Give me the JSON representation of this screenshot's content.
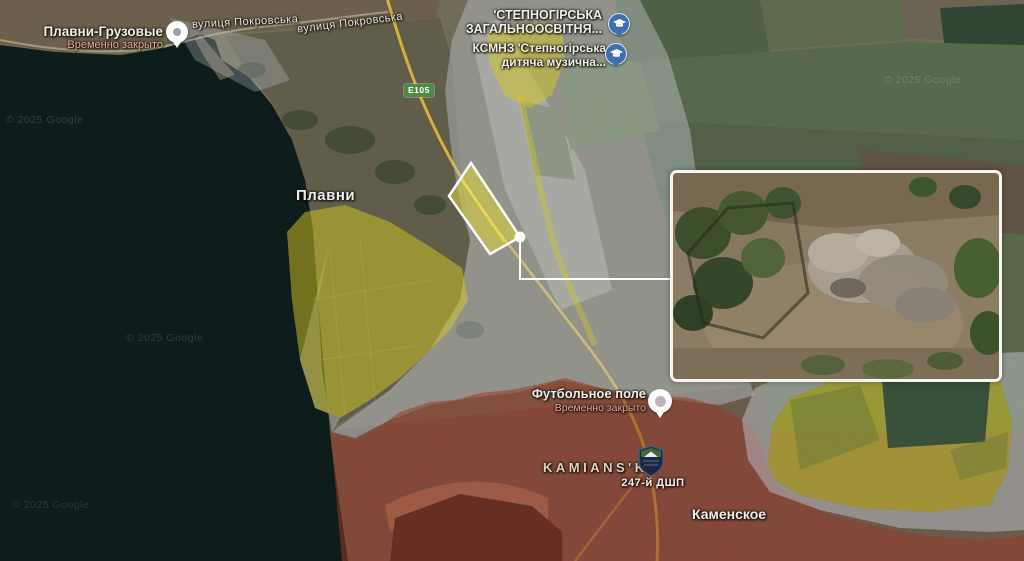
{
  "colors": {
    "zone_yellow": "#d6c821",
    "zone_red": "#96382a",
    "zone_gray": "#bcc3cc",
    "route_badge_bg": "#4e8c44",
    "school_pin_bg": "#3f6fae",
    "closed_status_color": "#e7a89e"
  },
  "labels": {
    "port_title": "Плавни-Грузовые",
    "port_status": "Временно закрыто",
    "street": "вулиця Покровська",
    "school1_line1": "'СТЕПНОГІРСЬКА",
    "school1_line2": "ЗАГАЛЬНООСВІТНЯ...",
    "school2_line1": "КСМНЗ 'Степногірська",
    "school2_line2": "дитяча музична...",
    "town_plavni": "Плавни",
    "route_badge": "E105",
    "football_title": "Футбольное поле",
    "football_status": "Временно закрыто",
    "city_kamianske": "KAMIANS'KE",
    "unit_badge": "247-й ДШП",
    "town_kamenskoe": "Каменское",
    "copyright": "© 2025 Google"
  }
}
